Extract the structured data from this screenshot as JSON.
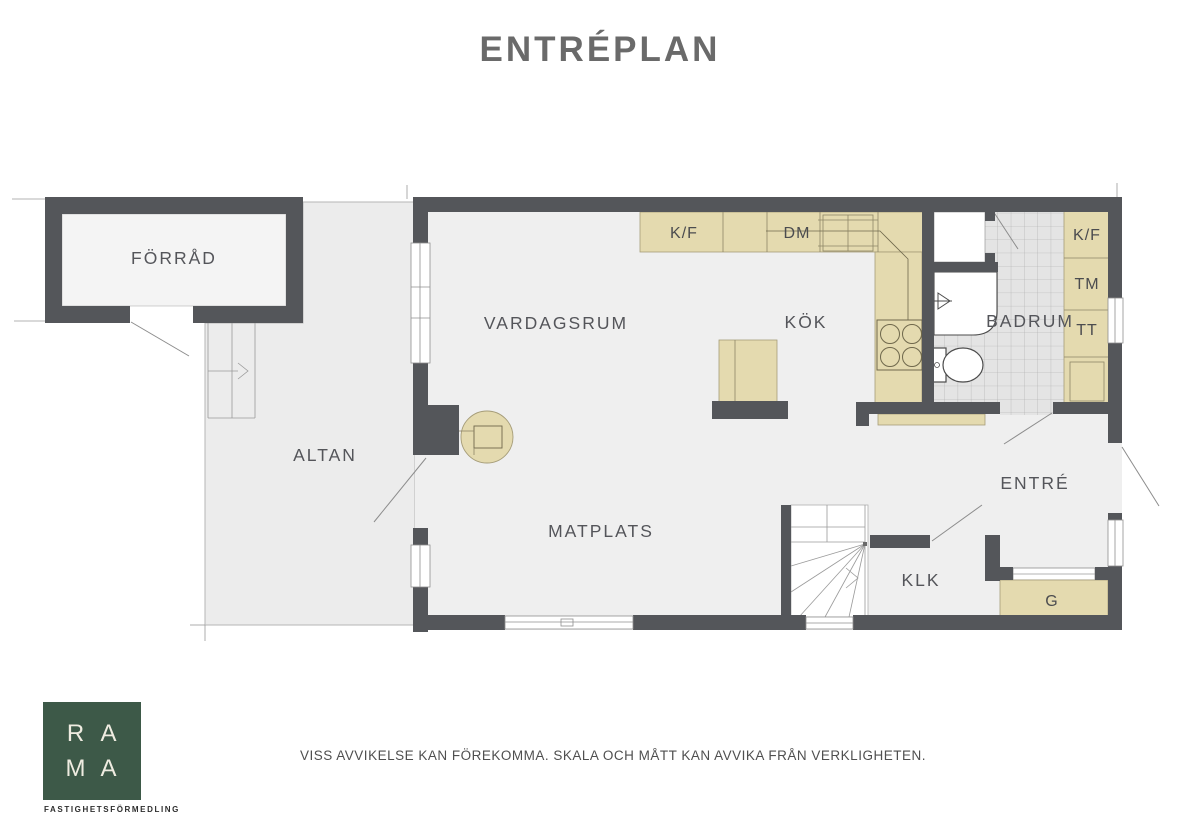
{
  "title": "ENTRÉPLAN",
  "plan": {
    "rooms": {
      "forrad": "FÖRRÅD",
      "vardagsrum": "VARDAGSRUM",
      "kok": "KÖK",
      "badrum": "BADRUM",
      "altan": "ALTAN",
      "matplats": "MATPLATS",
      "entre": "ENTRÉ",
      "klk": "KLK"
    },
    "appliances": {
      "kf_kitchen": "K/F",
      "dm": "DM",
      "kf_laundry": "K/F",
      "tm": "TM",
      "tt": "TT",
      "garderob": "G"
    }
  },
  "branding": {
    "letter_r": "R",
    "letter_a1": "A",
    "letter_m": "M",
    "letter_a2": "A",
    "tagline": "FASTIGHETSFÖRMEDLING"
  },
  "footer": {
    "disclaimer": "VISS AVVIKELSE KAN FÖREKOMMA. SKALA OCH MÅTT KAN AVVIKA FRÅN VERKLIGHETEN."
  },
  "colors": {
    "wall": "#54565a",
    "floor": "#efefef",
    "counter": "#e4daaf",
    "logo_green": "#3d5948"
  }
}
